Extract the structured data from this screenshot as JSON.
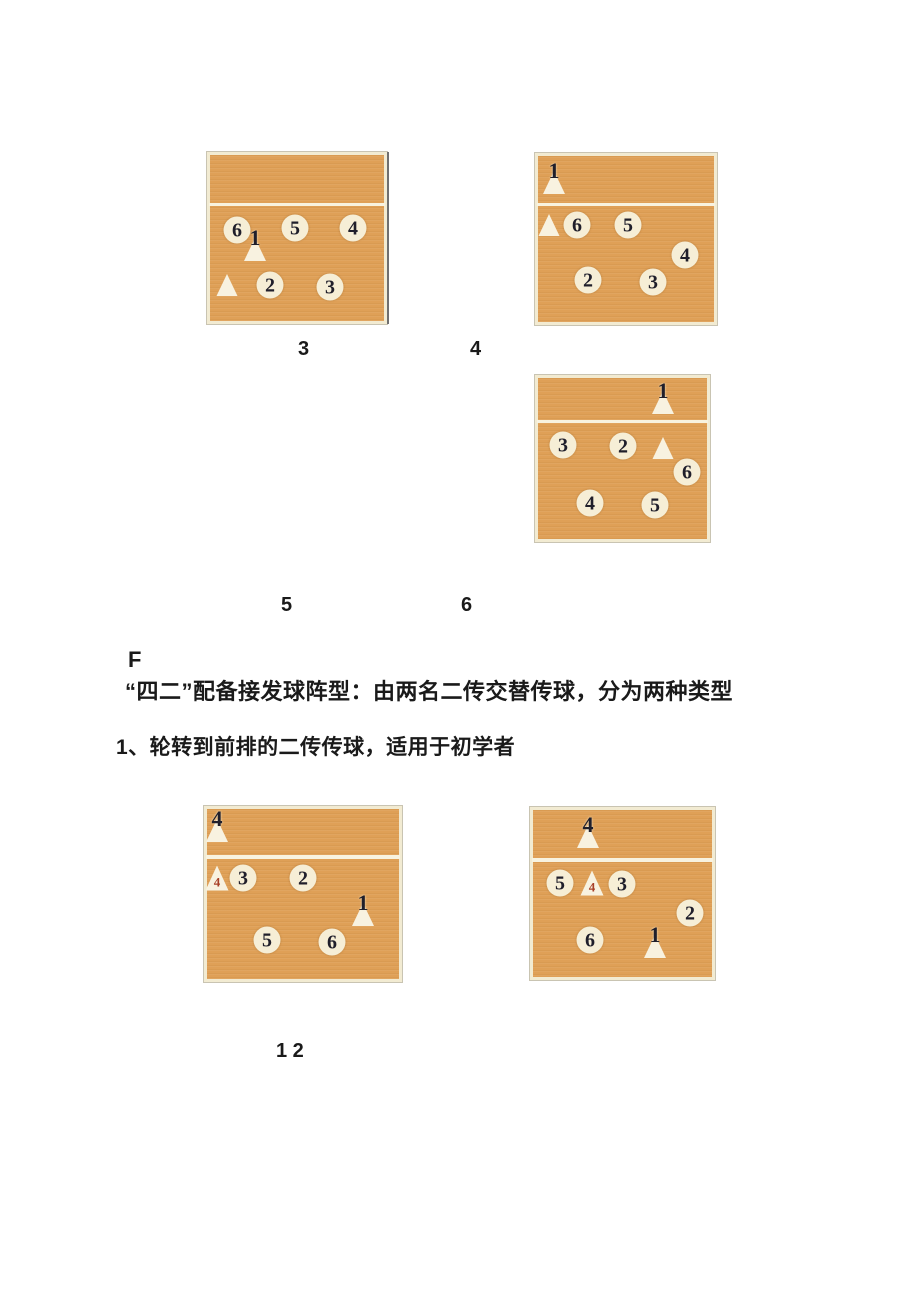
{
  "labels": {
    "fig3": "3",
    "fig4": "4",
    "fig5": "5",
    "fig6": "6",
    "fig12": "1 2",
    "section": "F"
  },
  "text": {
    "heading": "“四二”配备接发球阵型：由两名二传交替传球，分为两种类型",
    "subheading": "1、轮转到前排的二传传球，适用于初学者"
  },
  "colors": {
    "court_fill": "#dfa057",
    "court_border": "#f2ebd2",
    "net_line": "#f8f3e0",
    "marker_fill": "#f6eed6",
    "triangle_fill": "#f8f2e0",
    "number_dark": "#201f2b",
    "number_red": "#a84028",
    "text": "#1a1a1a"
  },
  "courts": [
    {
      "figure": "3",
      "players": [
        {
          "shape": "circle",
          "label": "6",
          "x": 27,
          "y": 75,
          "name": "player-6-circle"
        },
        {
          "shape": "tri-overlay",
          "label": "1",
          "x": 45,
          "y": 90,
          "name": "server-1-triangle-marker"
        },
        {
          "shape": "circle",
          "label": "5",
          "x": 85,
          "y": 73,
          "name": "player-5-circle"
        },
        {
          "shape": "circle",
          "label": "4",
          "x": 143,
          "y": 73,
          "name": "player-4-circle"
        },
        {
          "shape": "tri",
          "label": "",
          "x": 17,
          "y": 130,
          "name": "setter-triangle"
        },
        {
          "shape": "circle",
          "label": "2",
          "x": 60,
          "y": 130,
          "name": "player-2-circle"
        },
        {
          "shape": "circle",
          "label": "3",
          "x": 120,
          "y": 132,
          "name": "player-3-circle"
        }
      ]
    },
    {
      "figure": "4",
      "players": [
        {
          "shape": "tri-overlay",
          "label": "1",
          "x": 16,
          "y": 22,
          "name": "server-1-triangle-marker"
        },
        {
          "shape": "tri",
          "label": "",
          "x": 11,
          "y": 69,
          "name": "setter-triangle"
        },
        {
          "shape": "circle",
          "label": "6",
          "x": 39,
          "y": 69,
          "name": "player-6-circle"
        },
        {
          "shape": "circle",
          "label": "5",
          "x": 90,
          "y": 69,
          "name": "player-5-circle"
        },
        {
          "shape": "circle",
          "label": "4",
          "x": 147,
          "y": 99,
          "name": "player-4-circle"
        },
        {
          "shape": "circle",
          "label": "2",
          "x": 50,
          "y": 124,
          "name": "player-2-circle"
        },
        {
          "shape": "circle",
          "label": "3",
          "x": 115,
          "y": 126,
          "name": "player-3-circle"
        }
      ]
    },
    {
      "figure": "5-6",
      "players": [
        {
          "shape": "tri-overlay",
          "label": "1",
          "x": 125,
          "y": 20,
          "name": "server-1-triangle-marker"
        },
        {
          "shape": "circle",
          "label": "3",
          "x": 25,
          "y": 67,
          "name": "player-3-circle"
        },
        {
          "shape": "circle",
          "label": "2",
          "x": 85,
          "y": 68,
          "name": "player-2-circle"
        },
        {
          "shape": "tri",
          "label": "",
          "x": 125,
          "y": 70,
          "name": "setter-triangle"
        },
        {
          "shape": "circle",
          "label": "6",
          "x": 149,
          "y": 94,
          "name": "player-6-circle"
        },
        {
          "shape": "circle",
          "label": "4",
          "x": 52,
          "y": 125,
          "name": "player-4-circle"
        },
        {
          "shape": "circle",
          "label": "5",
          "x": 117,
          "y": 127,
          "name": "player-5-circle"
        }
      ]
    },
    {
      "figure": "1",
      "players": [
        {
          "shape": "tri-overlay",
          "label": "4",
          "x": 10,
          "y": 17,
          "name": "server-4-triangle-marker"
        },
        {
          "shape": "tri-red",
          "label": "4",
          "x": 10,
          "y": 69,
          "name": "setter-4-triangle"
        },
        {
          "shape": "circle",
          "label": "3",
          "x": 36,
          "y": 69,
          "name": "player-3-circle"
        },
        {
          "shape": "circle",
          "label": "2",
          "x": 96,
          "y": 69,
          "name": "player-2-circle"
        },
        {
          "shape": "tri-overlay",
          "label": "1",
          "x": 156,
          "y": 101,
          "name": "setter-1-triangle-marker"
        },
        {
          "shape": "circle",
          "label": "5",
          "x": 60,
          "y": 131,
          "name": "player-5-circle"
        },
        {
          "shape": "circle",
          "label": "6",
          "x": 125,
          "y": 133,
          "name": "player-6-circle"
        }
      ]
    },
    {
      "figure": "2",
      "players": [
        {
          "shape": "tri-overlay",
          "label": "4",
          "x": 55,
          "y": 22,
          "name": "server-4-triangle-marker"
        },
        {
          "shape": "circle",
          "label": "5",
          "x": 27,
          "y": 73,
          "name": "player-5-circle"
        },
        {
          "shape": "tri-red",
          "label": "4",
          "x": 59,
          "y": 73,
          "name": "setter-4-triangle"
        },
        {
          "shape": "circle",
          "label": "3",
          "x": 89,
          "y": 74,
          "name": "player-3-circle"
        },
        {
          "shape": "circle",
          "label": "2",
          "x": 157,
          "y": 103,
          "name": "player-2-circle"
        },
        {
          "shape": "circle",
          "label": "6",
          "x": 57,
          "y": 130,
          "name": "player-6-circle"
        },
        {
          "shape": "tri-overlay",
          "label": "1",
          "x": 122,
          "y": 132,
          "name": "setter-1-triangle-marker"
        }
      ]
    }
  ]
}
